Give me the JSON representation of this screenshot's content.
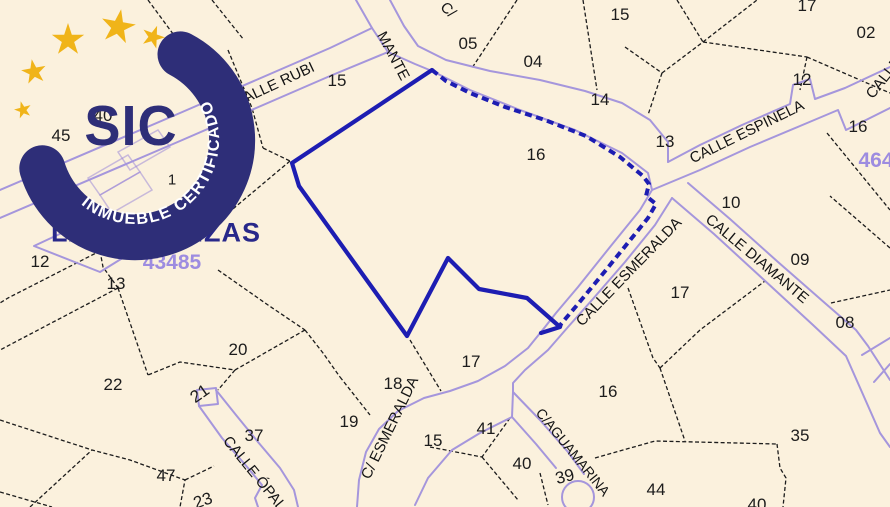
{
  "badge": {
    "acronym": "SIC",
    "ring_text": "INMUEBLE CERTIFICADO"
  },
  "map": {
    "district_label": "LAS PEDRIZAS",
    "block_numbers": [
      "43485",
      "464"
    ],
    "labels": [
      {
        "name": "district-label",
        "cls": "district",
        "text": "LAS PEDRIZAS",
        "x": 156,
        "y": 233
      },
      {
        "name": "block-number",
        "cls": "block",
        "text": "43485",
        "x": 172,
        "y": 263
      },
      {
        "name": "block-number",
        "cls": "block",
        "text": "464",
        "x": 876,
        "y": 161
      },
      {
        "name": "street-label-calle-rubi",
        "cls": "street",
        "text": "CALLE RUBI",
        "x": 274,
        "y": 85,
        "rot": -25
      },
      {
        "name": "street-label-mante-fragment",
        "cls": "street",
        "text": "MANTE",
        "x": 393,
        "y": 56,
        "rot": 62
      },
      {
        "name": "street-label-c-fragment",
        "cls": "street",
        "text": "C/",
        "x": 448,
        "y": 10,
        "rot": 45
      },
      {
        "name": "street-label-calle-espinela",
        "cls": "street",
        "text": "CALLE ESPINELA",
        "x": 747,
        "y": 132,
        "rot": -26
      },
      {
        "name": "street-label-calle-fragment",
        "cls": "street",
        "text": "CALLE",
        "x": 884,
        "y": 78,
        "rot": -52
      },
      {
        "name": "street-label-calle-esmeralda",
        "cls": "street",
        "text": "CALLE ESMERALDA",
        "x": 629,
        "y": 272,
        "rot": -46
      },
      {
        "name": "street-label-calle-diamante",
        "cls": "street",
        "text": "CALLE DIAMANTE",
        "x": 757,
        "y": 259,
        "rot": 40
      },
      {
        "name": "street-label-c-esmeralda",
        "cls": "street",
        "text": "C/ ESMERALDA",
        "x": 390,
        "y": 428,
        "rot": -64
      },
      {
        "name": "street-label-c-aguamarina",
        "cls": "street",
        "text": "C/AGUAMARINA",
        "x": 573,
        "y": 452,
        "rot": 51,
        "size": 14
      },
      {
        "name": "street-label-calle-opalo",
        "cls": "street",
        "text": "CALLE ÓPALO",
        "x": 258,
        "y": 478,
        "rot": 51
      },
      {
        "name": "parcel-number",
        "cls": "num",
        "text": "40",
        "x": 103,
        "y": 116
      },
      {
        "name": "parcel-number",
        "cls": "num",
        "text": "45",
        "x": 61,
        "y": 136
      },
      {
        "name": "parcel-number",
        "cls": "num",
        "text": "1",
        "x": 172,
        "y": 180,
        "size": 15
      },
      {
        "name": "parcel-number",
        "cls": "num",
        "text": "15",
        "x": 337,
        "y": 81
      },
      {
        "name": "parcel-number",
        "cls": "num",
        "text": "05",
        "x": 468,
        "y": 44
      },
      {
        "name": "parcel-number",
        "cls": "num",
        "text": "04",
        "x": 533,
        "y": 62
      },
      {
        "name": "parcel-number",
        "cls": "num",
        "text": "14",
        "x": 600,
        "y": 100
      },
      {
        "name": "parcel-number",
        "cls": "num",
        "text": "13",
        "x": 665,
        "y": 142
      },
      {
        "name": "parcel-number",
        "cls": "num",
        "text": "15",
        "x": 620,
        "y": 15
      },
      {
        "name": "parcel-number",
        "cls": "num",
        "text": "17",
        "x": 807,
        "y": 6
      },
      {
        "name": "parcel-number",
        "cls": "num",
        "text": "02",
        "x": 866,
        "y": 33
      },
      {
        "name": "parcel-number",
        "cls": "num",
        "text": "12",
        "x": 802,
        "y": 80
      },
      {
        "name": "parcel-number",
        "cls": "num",
        "text": "16",
        "x": 858,
        "y": 127
      },
      {
        "name": "parcel-number",
        "cls": "num",
        "text": "16",
        "x": 536,
        "y": 155
      },
      {
        "name": "parcel-number",
        "cls": "num",
        "text": "12",
        "x": 40,
        "y": 262
      },
      {
        "name": "parcel-number",
        "cls": "num",
        "text": "13",
        "x": 116,
        "y": 284
      },
      {
        "name": "parcel-number",
        "cls": "num",
        "text": "17",
        "x": 680,
        "y": 293
      },
      {
        "name": "parcel-number",
        "cls": "num",
        "text": "10",
        "x": 731,
        "y": 203
      },
      {
        "name": "parcel-number",
        "cls": "num",
        "text": "09",
        "x": 800,
        "y": 260
      },
      {
        "name": "parcel-number",
        "cls": "num",
        "text": "08",
        "x": 845,
        "y": 323
      },
      {
        "name": "parcel-number",
        "cls": "num",
        "text": "20",
        "x": 238,
        "y": 350
      },
      {
        "name": "parcel-number",
        "cls": "num",
        "text": "22",
        "x": 113,
        "y": 385
      },
      {
        "name": "parcel-number",
        "cls": "num",
        "text": "21",
        "x": 200,
        "y": 394,
        "rot": -35
      },
      {
        "name": "parcel-number",
        "cls": "num",
        "text": "18",
        "x": 393,
        "y": 384
      },
      {
        "name": "parcel-number",
        "cls": "num",
        "text": "19",
        "x": 349,
        "y": 422
      },
      {
        "name": "parcel-number",
        "cls": "num",
        "text": "17",
        "x": 471,
        "y": 362
      },
      {
        "name": "parcel-number",
        "cls": "num",
        "text": "37",
        "x": 254,
        "y": 436
      },
      {
        "name": "parcel-number",
        "cls": "num",
        "text": "15",
        "x": 433,
        "y": 441
      },
      {
        "name": "parcel-number",
        "cls": "num",
        "text": "41",
        "x": 486,
        "y": 429
      },
      {
        "name": "parcel-number",
        "cls": "num",
        "text": "40",
        "x": 522,
        "y": 464
      },
      {
        "name": "parcel-number",
        "cls": "num",
        "text": "39",
        "x": 565,
        "y": 477,
        "rot": -15
      },
      {
        "name": "parcel-number",
        "cls": "num",
        "text": "16",
        "x": 608,
        "y": 392
      },
      {
        "name": "parcel-number",
        "cls": "num",
        "text": "47",
        "x": 166,
        "y": 476
      },
      {
        "name": "parcel-number",
        "cls": "num",
        "text": "23",
        "x": 203,
        "y": 501,
        "rot": -20
      },
      {
        "name": "parcel-number",
        "cls": "num",
        "text": "44",
        "x": 656,
        "y": 490
      },
      {
        "name": "parcel-number",
        "cls": "num",
        "text": "35",
        "x": 800,
        "y": 436
      },
      {
        "name": "parcel-number",
        "cls": "num",
        "text": "40",
        "x": 757,
        "y": 505
      }
    ]
  },
  "colors": {
    "bg": "#fbf1dd",
    "ink": "#1c1c1c",
    "street": "#a596dc",
    "subject": "#1d1db2",
    "badge": "#2e2e78",
    "star": "#f0b419",
    "block": "#9d8ce0",
    "district": "#28288a"
  }
}
